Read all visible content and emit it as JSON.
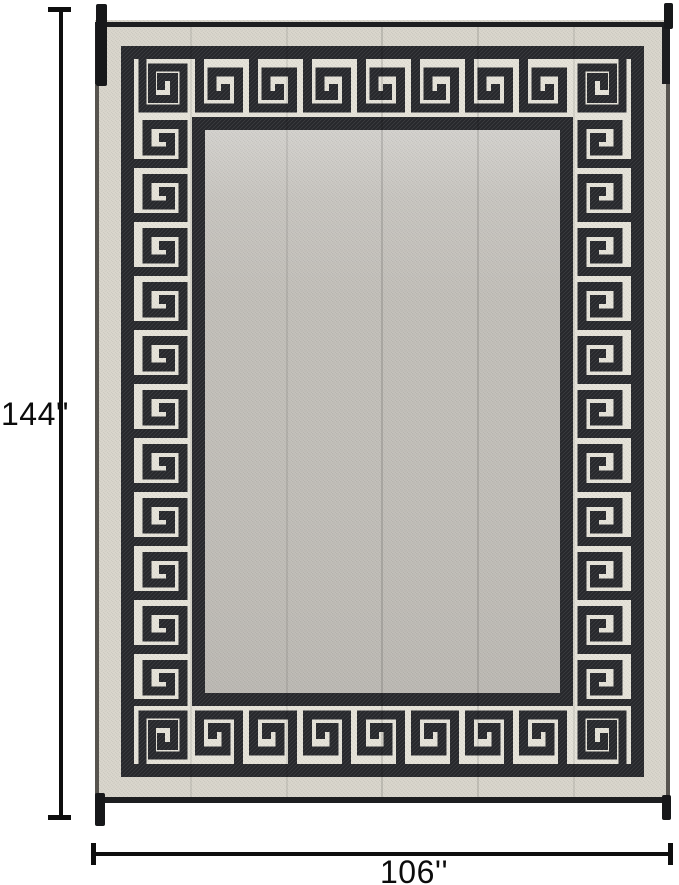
{
  "page": {
    "background": "#ffffff",
    "description": "Product dimension diagram of a reversible patio mat with Greek key border"
  },
  "rug": {
    "name": "greek-key-border-rug",
    "colors": {
      "pattern_black": "#26272b",
      "border_band_bg": "#e7e4da",
      "outer_margin": "#d9d6cc",
      "center_field": "#c2bfb9",
      "binding_edge": "#1d1e20"
    }
  },
  "annotations": {
    "line_color": "#0e0e0e",
    "height": {
      "label": "144''"
    },
    "width": {
      "label": "106''"
    }
  }
}
